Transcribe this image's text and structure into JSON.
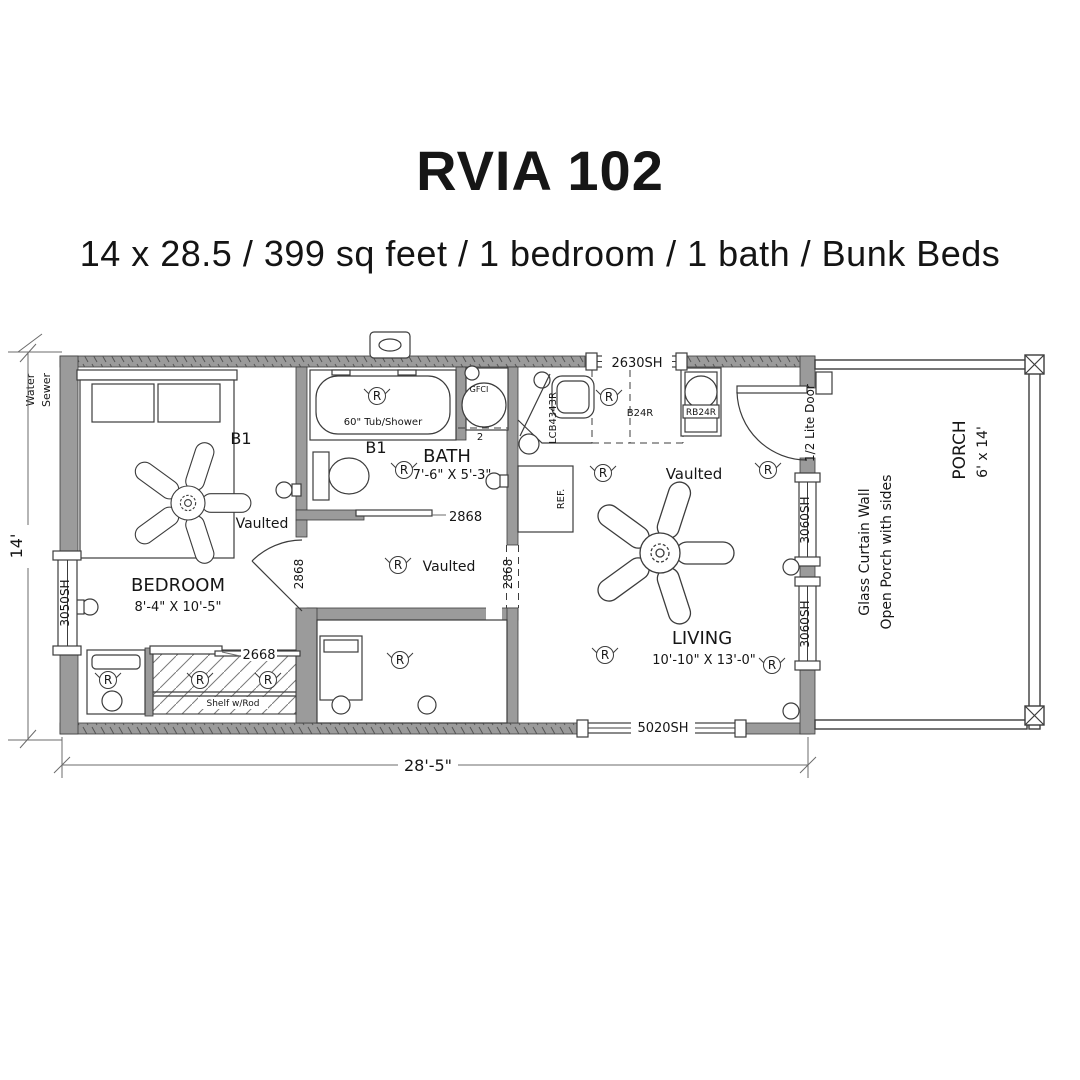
{
  "header": {
    "title": "RVIA 102",
    "subtitle": "14 x 28.5 / 399 sq feet / 1 bedroom / 1 bath / Bunk Beds"
  },
  "plan": {
    "dims": {
      "width": "28'-5\"",
      "height": "14'"
    },
    "site": {
      "water": "Water",
      "sewer": "Sewer"
    },
    "symbols": {
      "receptacle": "R"
    },
    "bedroom": {
      "name": "BEDROOM",
      "size": "8'-4\" X 10'-5\"",
      "ceiling": "Vaulted",
      "bed_label": "B1",
      "window": "3050SH",
      "door": "2868",
      "closet_door": "2668",
      "shelf": "Shelf w/Rod"
    },
    "bath": {
      "name": "BATH",
      "size": "7'-6\" X 5'-3\"",
      "tub": "60\" Tub/Shower",
      "gfci": "GFCI",
      "door": "2868",
      "label": "B1",
      "note": "2"
    },
    "kitchen": {
      "window": "2630SH",
      "sink_cabinet": "LCB4343R",
      "base_cabinet": "B24R",
      "range_cabinet": "RB24R",
      "fridge": "REF."
    },
    "hall": {
      "ceiling": "Vaulted",
      "opening": "2868"
    },
    "living": {
      "name": "LIVING",
      "size": "10'-10\" X 13'-0\"",
      "ceiling": "Vaulted",
      "entry_door": "1/2 Lite Door",
      "window_upper": "3060SH",
      "window_lower": "3060SH",
      "front_window": "5020SH"
    },
    "porch": {
      "name": "PORCH",
      "size": "6' x 14'",
      "note1": "Glass Curtain Wall",
      "note2": "Open Porch with sides"
    }
  }
}
